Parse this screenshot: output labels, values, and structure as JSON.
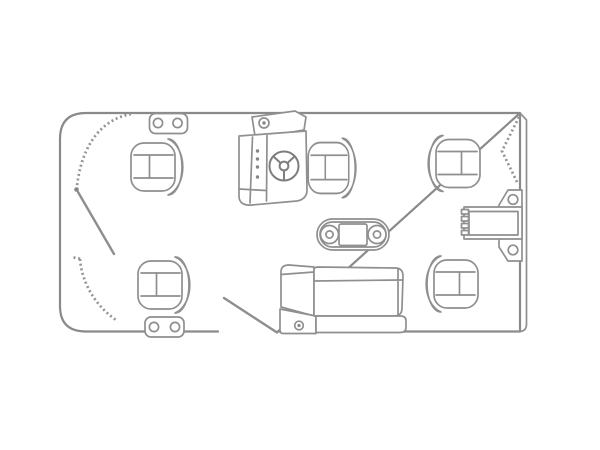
{
  "meta": {
    "title": "Pontoon boat floor plan",
    "drawing_type": "top-down line drawing",
    "background": "#ffffff",
    "line_color": "#8f8f8f",
    "dark_line_color": "#7e7e7e"
  },
  "components": {
    "deck_outline": {
      "label": "Pontoon deck outline"
    },
    "rub_rail": {
      "label": "Stern rub rail (double edge)"
    },
    "bow_fence_upper": {
      "label": "Bow fence rail, upper section"
    },
    "bow_fence_lower": {
      "label": "Bow fence rail, lower section"
    },
    "bow_gate": {
      "label": "Bow gate shown open"
    },
    "side_gate": {
      "label": "Side boarding gate shown open"
    },
    "stern_gate": {
      "label": "Stern gate shown open"
    },
    "hinge_top": {
      "label": "Deck hinge plate, top rail"
    },
    "hinge_bottom": {
      "label": "Deck hinge plate, bottom rail"
    },
    "helm_console": {
      "label": "Helm console with gauges"
    },
    "compass": {
      "label": "Helm compass"
    },
    "steering_wheel": {
      "label": "Steering wheel"
    },
    "helm_seat": {
      "label": "Captain's helm chair"
    },
    "seat_top_left": {
      "label": "Bow pedestal fishing seat, top"
    },
    "seat_bottom_left": {
      "label": "Bow pedestal fishing seat, bottom"
    },
    "seat_top_right": {
      "label": "Stern pedestal fishing seat, top"
    },
    "seat_bottom_right": {
      "label": "Stern pedestal fishing seat, bottom"
    },
    "table": {
      "label": "Dinette table with two cup holders"
    },
    "lounge": {
      "label": "Aft lounge bench with armrest"
    },
    "ladder": {
      "label": "Boarding ladder on transom bracket"
    }
  }
}
